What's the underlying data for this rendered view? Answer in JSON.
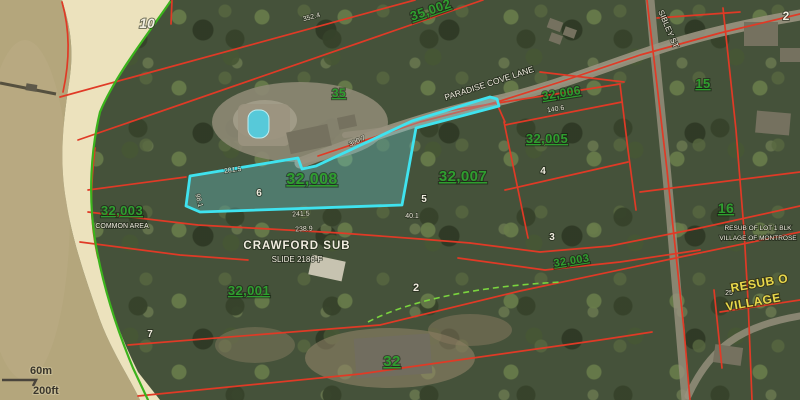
{
  "map_type": "aerial-parcel-map",
  "highlighted_parcel": "32,008",
  "parcel_labels": {
    "p10": "10",
    "p35": "35",
    "p35002": "35,002",
    "p32006": "32,006",
    "p32005": "32,005",
    "p32007": "32,007",
    "p32008": "32,008",
    "p32003_beach": "32,003",
    "p32003_strip": "32,003",
    "p32001": "32,001",
    "p15": "15",
    "p16": "16",
    "p32": "32",
    "p2": "2"
  },
  "lot_numbers": {
    "lot2": "2",
    "lot3": "3",
    "lot4": "4",
    "lot5": "5",
    "lot6": "6",
    "lot7": "7",
    "small25": "25"
  },
  "annotations": {
    "common_area": "COMMON AREA",
    "subdivision_name": "CRAWFORD SUB",
    "subdivision_slide": "SLIDE 2186-F",
    "resub_note_line1": "RESUB OF LOT 1 BLK",
    "resub_note_line2": "VILLAGE OF MONTROSE",
    "resub_yellow_line1": "RESUB O",
    "resub_yellow_line2": "VILLAGE"
  },
  "roads": {
    "paradise_cove": "PARADISE COVE LANE",
    "east_street": "SIBLEY ST"
  },
  "dimensions": {
    "d1": "352.4",
    "d2": "281.5",
    "d3": "300.7",
    "d4": "241.5",
    "d5": "238.9",
    "d6": "140.6",
    "d7": "98.1",
    "d8": "40.1"
  },
  "scale_bar": {
    "metric": "60m",
    "imperial": "200ft"
  },
  "colors": {
    "parcel_highlight": "#3fe3ef",
    "boundary_red": "#e03a26",
    "label_green": "#2f9e2f",
    "shoreline_green": "#3bb31c",
    "annotation_yellow": "#e9d84b",
    "water": "#b4a67c",
    "sand": "#ece2bd"
  }
}
